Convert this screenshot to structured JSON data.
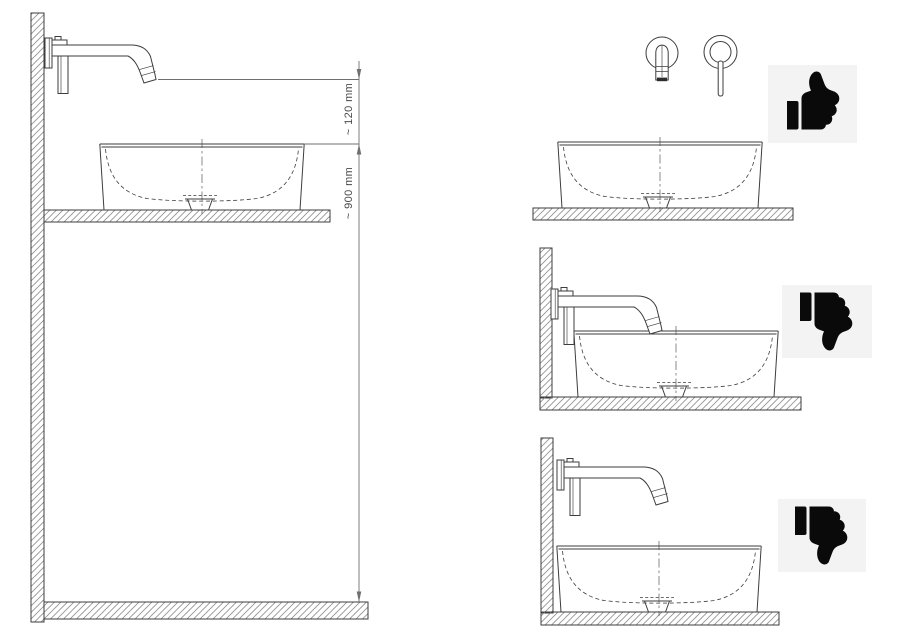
{
  "page": {
    "background": "#ffffff"
  },
  "main_diagram": {
    "labels": {
      "spout_to_basin": "~ 120 mm",
      "floor_to_basin": "~ 900 mm"
    }
  },
  "verdict_panels": [
    {
      "icon": "thumbs-up-icon"
    },
    {
      "icon": "thumbs-down-icon"
    },
    {
      "icon": "thumbs-down-icon"
    }
  ],
  "colors": {
    "line": "#3d3d3d",
    "hatch": "#8f8f8f",
    "dimension": "#6f6f6f",
    "label_text": "#4a4a4a",
    "panel_bg": "#f3f3f3",
    "icon": "#0a0a0a",
    "page_bg": "#ffffff"
  }
}
